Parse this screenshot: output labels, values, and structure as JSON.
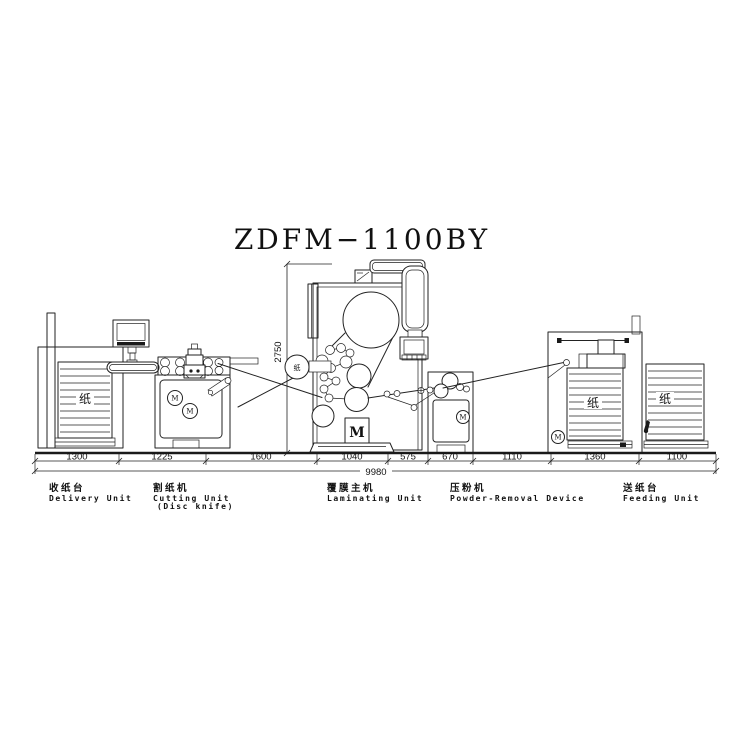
{
  "title": "ZDFM−1100BY",
  "diagram": {
    "total_length": "9980",
    "height_dim": "2750",
    "segment_dims": [
      "1300",
      "1225",
      "1600",
      "1040",
      "575",
      "670",
      "1110",
      "1360",
      "1100"
    ],
    "paper_label": "纸",
    "motor_label": "M",
    "units": [
      {
        "name_zh": "收纸台",
        "name_en": "Delivery Unit"
      },
      {
        "name_zh": "割纸机",
        "name_en": "Cutting Unit",
        "name_en2": "(Disc knife)"
      },
      {
        "name_zh": "覆膜主机",
        "name_en": "Laminating Unit"
      },
      {
        "name_zh": "压粉机",
        "name_en": "Powder-Removal Device"
      },
      {
        "name_zh": "送纸台",
        "name_en": "Feeding Unit"
      }
    ]
  }
}
